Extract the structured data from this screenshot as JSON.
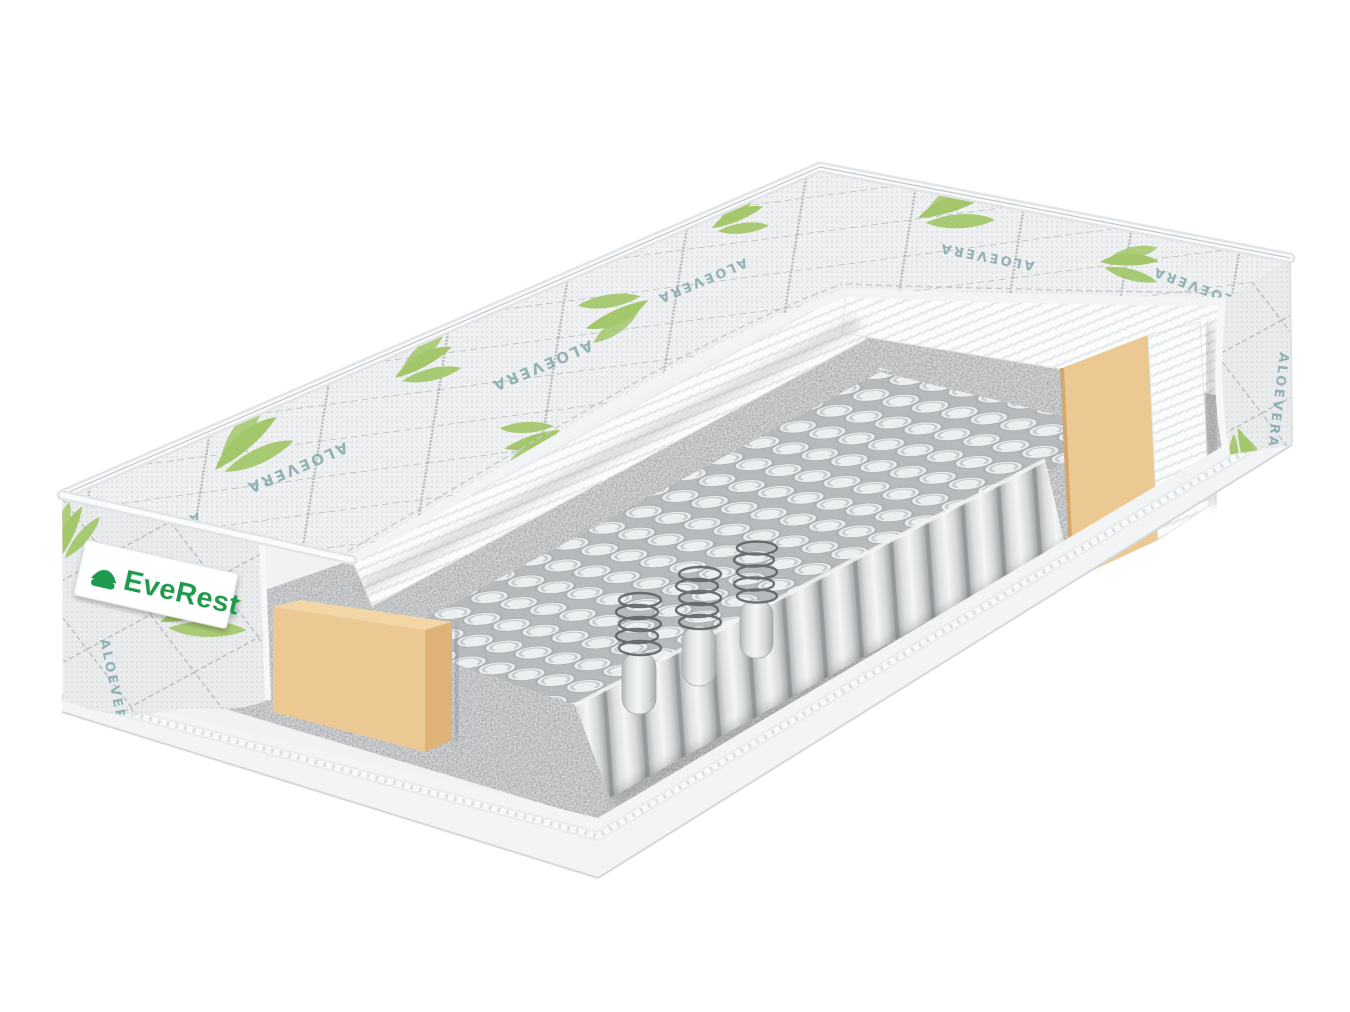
{
  "scene": {
    "type": "product-photo",
    "subject": "Cutaway render of a pocket-spring mattress",
    "background_color": "#ffffff"
  },
  "brand_label": {
    "text": "EveRest",
    "text_color": "#1e9b4d",
    "background_color": "#ffffff",
    "icon": "bed-logo-icon"
  },
  "fabric_print": {
    "text": "ALOEVERA",
    "text_color": "#84a8ac",
    "leaf_color": "#a3c76a",
    "cover_base_color": "#eef0f1"
  },
  "material_colors": {
    "foam_edge_block": "#ecc892",
    "felt_pad": "#8f9294",
    "spring_pocket_fabric": "#eceff0",
    "metal_coil": "#5f6366",
    "foam_layer": "#fbfcfc",
    "border_band": "#f3f4f5",
    "piping_cord": "#eef0f1"
  }
}
